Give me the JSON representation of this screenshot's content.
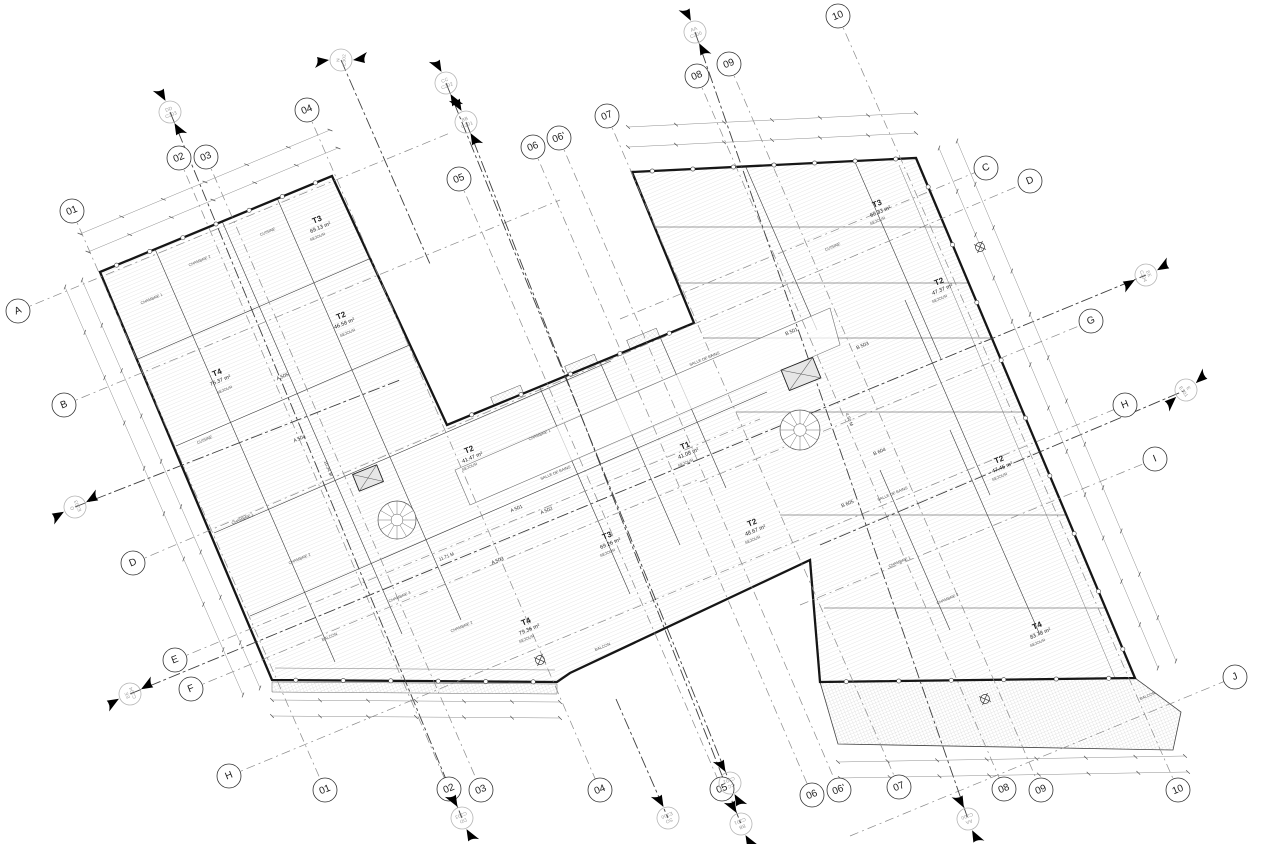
{
  "drawing": {
    "kind": "architectural-floor-plan",
    "ink": "#1b1b1b",
    "grid_color": "#8a8a8a",
    "section_color": "#3f3f3f",
    "hatch_color": "#cccccc"
  },
  "grid_bubbles": [
    {
      "label": "01",
      "x": 72,
      "y": 211,
      "side": "top"
    },
    {
      "label": "02",
      "x": 179,
      "y": 158,
      "side": "top"
    },
    {
      "label": "03",
      "x": 206,
      "y": 157,
      "side": "top"
    },
    {
      "label": "04",
      "x": 307,
      "y": 110,
      "side": "top"
    },
    {
      "label": "05",
      "x": 459,
      "y": 179,
      "side": "top"
    },
    {
      "label": "06",
      "x": 533,
      "y": 147,
      "side": "top"
    },
    {
      "label": "06'",
      "x": 559,
      "y": 138,
      "side": "top"
    },
    {
      "label": "07",
      "x": 607,
      "y": 116,
      "side": "top"
    },
    {
      "label": "08",
      "x": 697,
      "y": 76,
      "side": "top"
    },
    {
      "label": "09",
      "x": 729,
      "y": 64,
      "side": "top"
    },
    {
      "label": "10",
      "x": 838,
      "y": 16,
      "side": "top"
    },
    {
      "label": "01",
      "x": 325,
      "y": 790,
      "side": "bottom"
    },
    {
      "label": "02",
      "x": 449,
      "y": 789,
      "side": "bottom"
    },
    {
      "label": "03",
      "x": 481,
      "y": 790,
      "side": "bottom"
    },
    {
      "label": "04",
      "x": 600,
      "y": 790,
      "side": "bottom"
    },
    {
      "label": "05",
      "x": 722,
      "y": 789,
      "side": "bottom"
    },
    {
      "label": "06",
      "x": 812,
      "y": 795,
      "side": "bottom"
    },
    {
      "label": "06'",
      "x": 839,
      "y": 790,
      "side": "bottom"
    },
    {
      "label": "07",
      "x": 899,
      "y": 787,
      "side": "bottom"
    },
    {
      "label": "08",
      "x": 1004,
      "y": 789,
      "side": "bottom"
    },
    {
      "label": "09",
      "x": 1041,
      "y": 790,
      "side": "bottom"
    },
    {
      "label": "10",
      "x": 1178,
      "y": 790,
      "side": "bottom"
    },
    {
      "label": "A",
      "x": 18,
      "y": 311,
      "side": "left"
    },
    {
      "label": "B",
      "x": 64,
      "y": 405,
      "side": "left"
    },
    {
      "label": "D",
      "x": 133,
      "y": 563,
      "side": "left"
    },
    {
      "label": "E",
      "x": 175,
      "y": 660,
      "side": "left"
    },
    {
      "label": "F",
      "x": 191,
      "y": 689,
      "side": "left"
    },
    {
      "label": "H",
      "x": 229,
      "y": 776,
      "side": "left"
    },
    {
      "label": "C",
      "x": 986,
      "y": 168,
      "side": "right"
    },
    {
      "label": "D",
      "x": 1030,
      "y": 181,
      "side": "right"
    },
    {
      "label": "G",
      "x": 1091,
      "y": 321,
      "side": "right"
    },
    {
      "label": "H",
      "x": 1125,
      "y": 405,
      "side": "right"
    },
    {
      "label": "I",
      "x": 1155,
      "y": 459,
      "side": "right"
    },
    {
      "label": "J",
      "x": 1235,
      "y": 677,
      "side": "right"
    }
  ],
  "grid_lines": [
    {
      "x1": 72,
      "y1": 211,
      "x2": 325,
      "y2": 790
    },
    {
      "x1": 179,
      "y1": 158,
      "x2": 449,
      "y2": 789
    },
    {
      "x1": 206,
      "y1": 157,
      "x2": 481,
      "y2": 790
    },
    {
      "x1": 307,
      "y1": 110,
      "x2": 600,
      "y2": 790
    },
    {
      "x1": 459,
      "y1": 179,
      "x2": 722,
      "y2": 789
    },
    {
      "x1": 533,
      "y1": 147,
      "x2": 812,
      "y2": 795
    },
    {
      "x1": 559,
      "y1": 138,
      "x2": 839,
      "y2": 790
    },
    {
      "x1": 607,
      "y1": 116,
      "x2": 899,
      "y2": 787
    },
    {
      "x1": 697,
      "y1": 76,
      "x2": 1004,
      "y2": 789
    },
    {
      "x1": 729,
      "y1": 64,
      "x2": 1041,
      "y2": 790
    },
    {
      "x1": 838,
      "y1": 16,
      "x2": 1178,
      "y2": 790
    },
    {
      "x1": 18,
      "y1": 311,
      "x2": 450,
      "y2": 133
    },
    {
      "x1": 64,
      "y1": 405,
      "x2": 560,
      "y2": 200
    },
    {
      "x1": 620,
      "y1": 319,
      "x2": 986,
      "y2": 168
    },
    {
      "x1": 133,
      "y1": 563,
      "x2": 1030,
      "y2": 181
    },
    {
      "x1": 175,
      "y1": 660,
      "x2": 760,
      "y2": 419
    },
    {
      "x1": 191,
      "y1": 689,
      "x2": 700,
      "y2": 479
    },
    {
      "x1": 700,
      "y1": 482,
      "x2": 1091,
      "y2": 321
    },
    {
      "x1": 229,
      "y1": 776,
      "x2": 1125,
      "y2": 405
    },
    {
      "x1": 800,
      "y1": 605,
      "x2": 1155,
      "y2": 459
    },
    {
      "x1": 850,
      "y1": 836,
      "x2": 1235,
      "y2": 677
    }
  ],
  "section_markers": [
    {
      "line1": "N",
      "line2": "E302",
      "x": 341,
      "y": 60,
      "dir": 0,
      "flags": 2
    },
    {
      "line1": "DD",
      "line2": "C203",
      "x": 170,
      "y": 112,
      "dir": 68,
      "flags": 2
    },
    {
      "line1": "CC",
      "line2": "C202",
      "x": 446,
      "y": 83,
      "dir": 68,
      "flags": 2
    },
    {
      "line1": "BB",
      "line2": "C201",
      "x": 466,
      "y": 122,
      "dir": 68,
      "flags": 2
    },
    {
      "line1": "AA",
      "line2": "C200",
      "x": 695,
      "y": 32,
      "dir": 70,
      "flags": 2
    },
    {
      "line1": "O",
      "line2": "E303",
      "x": 75,
      "y": 507,
      "dir": -23,
      "flags": 2
    },
    {
      "line1": "EE",
      "line2": "C204",
      "x": 130,
      "y": 694,
      "dir": -23,
      "flags": 2
    },
    {
      "line1": "EE",
      "line2": "C204",
      "x": 1146,
      "y": 275,
      "dir": 157,
      "flags": 2
    },
    {
      "line1": "E",
      "line2": "E301",
      "x": 1186,
      "y": 390,
      "dir": 145,
      "flags": 2
    },
    {
      "line1": "DD",
      "line2": "C203",
      "x": 462,
      "y": 818,
      "dir": 248,
      "flags": 2
    },
    {
      "line1": "SO",
      "line2": "E300",
      "x": 668,
      "y": 818,
      "dir": 248,
      "flags": 1
    },
    {
      "line1": "CC",
      "line2": "C202",
      "x": 730,
      "y": 783,
      "dir": 248,
      "flags": 2
    },
    {
      "line1": "BB",
      "line2": "C201",
      "x": 741,
      "y": 824,
      "dir": 248,
      "flags": 2
    },
    {
      "line1": "AA",
      "line2": "C200",
      "x": 968,
      "y": 819,
      "dir": 250,
      "flags": 2
    }
  ],
  "section_lines": [
    {
      "x1": 170,
      "y1": 112,
      "x2": 462,
      "y2": 818
    },
    {
      "x1": 446,
      "y1": 83,
      "x2": 730,
      "y2": 783
    },
    {
      "x1": 466,
      "y1": 122,
      "x2": 741,
      "y2": 824
    },
    {
      "x1": 695,
      "y1": 32,
      "x2": 968,
      "y2": 819
    },
    {
      "x1": 130,
      "y1": 694,
      "x2": 1146,
      "y2": 275
    },
    {
      "x1": 341,
      "y1": 60,
      "x2": 430,
      "y2": 264
    },
    {
      "x1": 820,
      "y1": 545,
      "x2": 1186,
      "y2": 390
    },
    {
      "x1": 75,
      "y1": 507,
      "x2": 400,
      "y2": 380
    },
    {
      "x1": 616,
      "y1": 699,
      "x2": 668,
      "y2": 818
    }
  ],
  "apartments": [
    {
      "type": "T3",
      "area": "69.13 m²",
      "x": 318,
      "y": 222
    },
    {
      "type": "T2",
      "area": "46.58 m²",
      "x": 342,
      "y": 318
    },
    {
      "type": "T4",
      "area": "76.37 m²",
      "x": 218,
      "y": 375
    },
    {
      "type": "T2",
      "area": "41.47 m²",
      "x": 470,
      "y": 452
    },
    {
      "type": "T1",
      "area": "41.08 m²",
      "x": 686,
      "y": 448
    },
    {
      "type": "T3",
      "area": "69.26 m²",
      "x": 608,
      "y": 538
    },
    {
      "type": "T4",
      "area": "79.36 m²",
      "x": 527,
      "y": 624
    },
    {
      "type": "T2",
      "area": "48.67 m²",
      "x": 753,
      "y": 525
    },
    {
      "type": "T3",
      "area": "69.33 m²",
      "x": 878,
      "y": 206
    },
    {
      "type": "T2",
      "area": "47.37 m²",
      "x": 940,
      "y": 284
    },
    {
      "type": "T2",
      "area": "47.45 m²",
      "x": 1000,
      "y": 462
    },
    {
      "type": "T4",
      "area": "83.78 m²",
      "x": 1038,
      "y": 628
    }
  ],
  "unit_tags": [
    {
      "label": "A 501",
      "x": 517,
      "y": 510
    },
    {
      "label": "A 502",
      "x": 547,
      "y": 512
    },
    {
      "label": "A 503",
      "x": 498,
      "y": 562
    },
    {
      "label": "A 504",
      "x": 300,
      "y": 440
    },
    {
      "label": "A 505",
      "x": 283,
      "y": 378
    },
    {
      "label": "B 501",
      "x": 792,
      "y": 333
    },
    {
      "label": "B 503",
      "x": 863,
      "y": 347
    },
    {
      "label": "B 604",
      "x": 880,
      "y": 453
    },
    {
      "label": "B 605",
      "x": 848,
      "y": 505
    }
  ],
  "room_labels": [
    {
      "t": "CUISINE",
      "x": 268,
      "y": 233
    },
    {
      "t": "CHAMBRE 1",
      "x": 152,
      "y": 300
    },
    {
      "t": "CHAMBRE 2",
      "x": 200,
      "y": 262
    },
    {
      "t": "SEJOUR",
      "x": 318,
      "y": 238
    },
    {
      "t": "SEJOUR",
      "x": 348,
      "y": 334
    },
    {
      "t": "SEJOUR",
      "x": 225,
      "y": 391
    },
    {
      "t": "CUISINE",
      "x": 205,
      "y": 441
    },
    {
      "t": "CHAMBRE 1",
      "x": 243,
      "y": 520
    },
    {
      "t": "CHAMBRE 2",
      "x": 300,
      "y": 560
    },
    {
      "t": "BALCON",
      "x": 330,
      "y": 638
    },
    {
      "t": "SEJOUR",
      "x": 470,
      "y": 468
    },
    {
      "t": "CHAMBRE 1",
      "x": 540,
      "y": 436
    },
    {
      "t": "SEJOUR",
      "x": 608,
      "y": 554
    },
    {
      "t": "SEJOUR",
      "x": 527,
      "y": 640
    },
    {
      "t": "SEJOUR",
      "x": 686,
      "y": 464
    },
    {
      "t": "SEJOUR",
      "x": 753,
      "y": 541
    },
    {
      "t": "SEJOUR",
      "x": 878,
      "y": 222
    },
    {
      "t": "CUISINE",
      "x": 833,
      "y": 248
    },
    {
      "t": "SEJOUR",
      "x": 940,
      "y": 300
    },
    {
      "t": "SEJOUR",
      "x": 1000,
      "y": 478
    },
    {
      "t": "SEJOUR",
      "x": 1038,
      "y": 644
    },
    {
      "t": "CHAMBRE 1",
      "x": 900,
      "y": 563
    },
    {
      "t": "CHAMBRE 2",
      "x": 948,
      "y": 600
    },
    {
      "t": "SALLE DE BAINS",
      "x": 705,
      "y": 360
    },
    {
      "t": "SALLE DE BAINS",
      "x": 556,
      "y": 474
    },
    {
      "t": "SALLE DE BAINS",
      "x": 893,
      "y": 495
    },
    {
      "t": "CHAMBRE 3",
      "x": 400,
      "y": 598
    },
    {
      "t": "CHAMBRE 2",
      "x": 462,
      "y": 628
    },
    {
      "t": "BALCON",
      "x": 1148,
      "y": 697
    },
    {
      "t": "BALCON",
      "x": 603,
      "y": 648
    }
  ],
  "dim_labels": [
    {
      "text": "11.71 M",
      "x": 447,
      "y": 558,
      "rot": -22
    },
    {
      "text": "10.34 M",
      "x": 327,
      "y": 469,
      "rot": 68
    },
    {
      "text": "4.50 M",
      "x": 848,
      "y": 420,
      "rot": 68
    }
  ],
  "dim_chains": [
    {
      "x1": 272,
      "y1": 700,
      "x2": 560,
      "y2": 702
    },
    {
      "x1": 272,
      "y1": 716,
      "x2": 560,
      "y2": 718
    },
    {
      "x1": 838,
      "y1": 762,
      "x2": 1185,
      "y2": 756
    },
    {
      "x1": 840,
      "y1": 778,
      "x2": 1188,
      "y2": 772
    },
    {
      "x1": 88,
      "y1": 252,
      "x2": 338,
      "y2": 148
    },
    {
      "x1": 80,
      "y1": 234,
      "x2": 330,
      "y2": 130
    },
    {
      "x1": 628,
      "y1": 147,
      "x2": 916,
      "y2": 133
    },
    {
      "x1": 628,
      "y1": 127,
      "x2": 916,
      "y2": 113
    },
    {
      "x1": 939,
      "y1": 148,
      "x2": 1158,
      "y2": 668
    },
    {
      "x1": 957,
      "y1": 141,
      "x2": 1176,
      "y2": 661
    },
    {
      "x1": 82,
      "y1": 280,
      "x2": 260,
      "y2": 688
    },
    {
      "x1": 65,
      "y1": 287,
      "x2": 243,
      "y2": 695
    }
  ],
  "facade_dots": [
    {
      "x1": 100,
      "y1": 272,
      "x2": 332,
      "y2": 176,
      "n": 7
    },
    {
      "x1": 632,
      "y1": 172,
      "x2": 916,
      "y2": 158,
      "n": 7
    },
    {
      "x1": 916,
      "y1": 158,
      "x2": 1135,
      "y2": 678,
      "n": 9
    },
    {
      "x1": 272,
      "y1": 680,
      "x2": 557,
      "y2": 682,
      "n": 6
    },
    {
      "x1": 447,
      "y1": 425,
      "x2": 694,
      "y2": 323,
      "n": 5
    },
    {
      "x1": 820,
      "y1": 682,
      "x2": 1135,
      "y2": 678,
      "n": 6
    }
  ],
  "benchmarks": [
    {
      "x": 540,
      "y": 660
    },
    {
      "x": 985,
      "y": 699
    },
    {
      "x": 980,
      "y": 247
    }
  ],
  "stairs": [
    {
      "x": 397,
      "y": 520,
      "r": 19
    },
    {
      "x": 800,
      "y": 430,
      "r": 20
    }
  ],
  "elevators": [
    {
      "x": 368,
      "y": 478,
      "w": 26,
      "h": 18,
      "rot": -22
    },
    {
      "x": 801,
      "y": 374,
      "w": 34,
      "h": 22,
      "rot": -22
    }
  ]
}
